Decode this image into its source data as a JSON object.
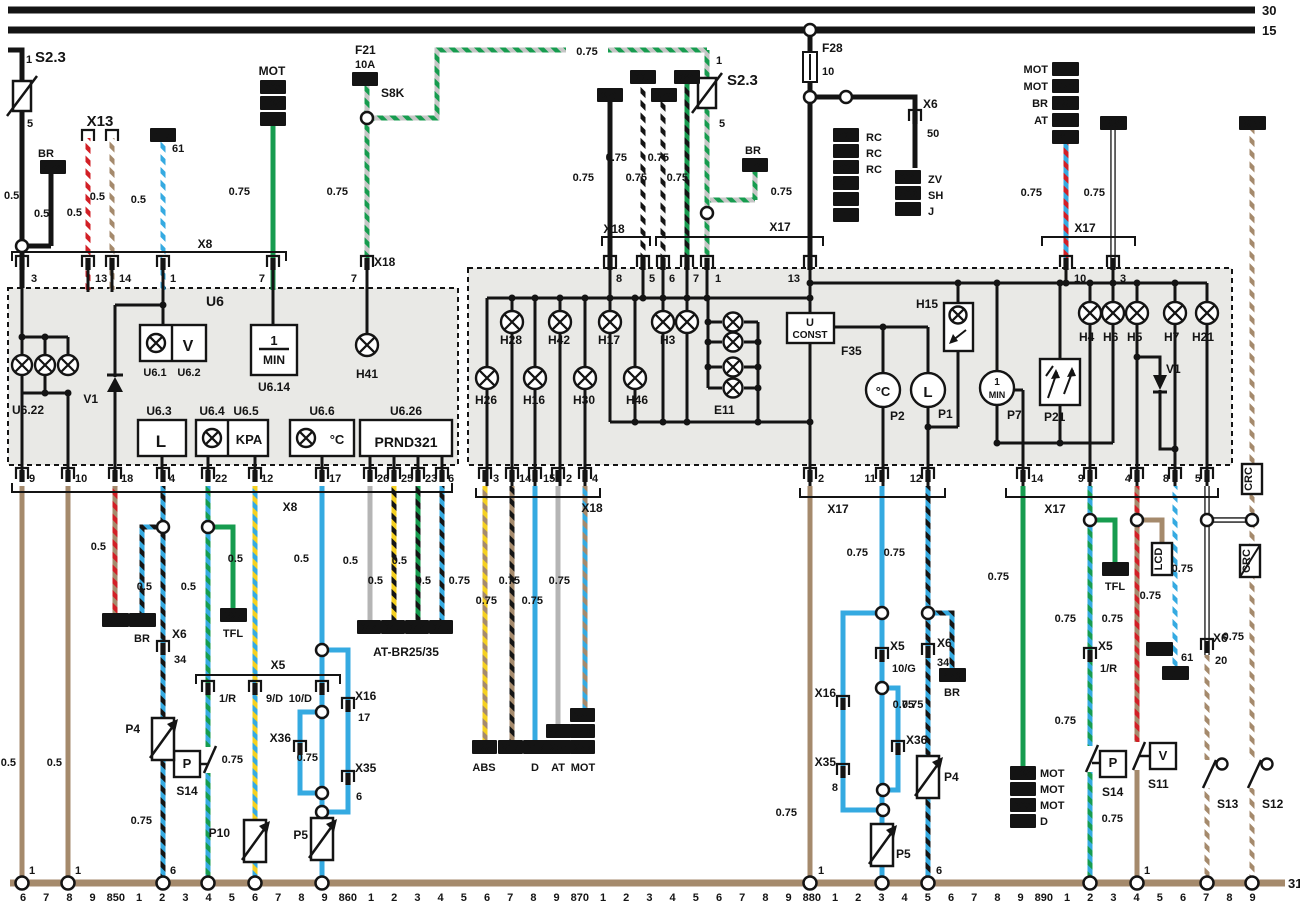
{
  "colors": {
    "black": "#141414",
    "tan": "#a58a6c",
    "red": "#d21f26",
    "green": "#179c4f",
    "blue": "#35aae1",
    "yellow": "#f5d020",
    "gray": "#b5b5b5",
    "lightgray": "#c6c6c6",
    "boxfill": "#e9e9e6",
    "white": "#ffffff"
  },
  "t": {
    "n30": "30",
    "n15": "15",
    "n31": "31",
    "n1": "1",
    "n2": "2",
    "n3": "3",
    "n4": "4",
    "n5": "5",
    "n6": "6",
    "n7": "7",
    "n8": "8",
    "n9": "9",
    "n10": "10",
    "n11": "11",
    "n12": "12",
    "n13": "13",
    "n14": "14",
    "n17": "17",
    "n18": "18",
    "n20": "20",
    "n22": "22",
    "n23": "23",
    "n25": "25",
    "n26": "26",
    "n34": "34",
    "n50": "50",
    "n61": "61",
    "s05": "0.5",
    "s075": "0.75",
    "s23": "S2.3",
    "x5": "X5",
    "x6": "X6",
    "x8": "X8",
    "x13": "X13",
    "x16": "X16",
    "x17": "X17",
    "x18": "X18",
    "x35": "X35",
    "x36": "X36",
    "p1r": "1/R",
    "p9d": "9/D",
    "p10d": "10/D",
    "p10g": "10/G",
    "f21": "F21",
    "f21a": "10A",
    "s8k": "S8K",
    "f28": "F28",
    "f35": "F35",
    "br": "BR",
    "mot": "MOT",
    "at": "AT",
    "rc": "RC",
    "zv": "ZV",
    "sh": "SH",
    "j": "J",
    "tfl": "TFL",
    "abs": "ABS",
    "d": "D",
    "lcd": "LCD",
    "crc": "CRC",
    "atbr": "AT-BR25/35",
    "u6": "U6",
    "u61": "U6.1",
    "u62": "U6.2",
    "u63": "U6.3",
    "u64": "U6.4",
    "u65": "U6.5",
    "u66": "U6.6",
    "u614": "U6.14",
    "u622": "U6.22",
    "u626": "U6.26",
    "l": "L",
    "v": "V",
    "kpa": "KPA",
    "degc": "°C",
    "prnd": "PRND321",
    "one": "1",
    "min": "MIN",
    "u": "U",
    "konst": "CONST",
    "p": "P",
    "v1": "V1",
    "h41": "H41",
    "h28": "H28",
    "h42": "H42",
    "h17": "H17",
    "h3": "H3",
    "h26": "H26",
    "h16": "H16",
    "h30": "H30",
    "h46": "H46",
    "e11": "E11",
    "h15": "H15",
    "h4": "H4",
    "h6": "H6",
    "h5": "H5",
    "h7": "H7",
    "h21": "H21",
    "p1": "P1",
    "p2": "P2",
    "p4": "P4",
    "p5": "P5",
    "p7": "P7",
    "p10": "P10",
    "p21": "P21",
    "s11": "S11",
    "s12": "S12",
    "s13": "S13",
    "s14": "S14",
    "r474": "474",
    "r963": "963",
    "r136": "136",
    "r270": "270",
    "r115": "115",
    "r315": "315",
    "r370": "370",
    "r225": "225",
    "r379": "379",
    "r280": "280",
    "r721": "721",
    "r746": "746",
    "r760": "760",
    "r641": "641",
    "r616": "616",
    "r410": "410",
    "r600": "600",
    "r562": "562",
    "r201": "201",
    "r975": "975",
    "r273": "273",
    "r480": "480",
    "r442": "442",
    "r612": "612",
    "r336": "336",
    "r800": "800",
    "r895": "895",
    "r476": "476",
    "r327": "327",
    "r244": "244",
    "r245": "245",
    "r246": "246",
    "r247": "247",
    "r974": "974",
    "r441": "441",
    "r149": "149",
    "r250": "250",
    "r272": "272",
    "r584": "584",
    "r817": "817",
    "r912": "912",
    "r850": "850",
    "r116": "116"
  },
  "rail": {
    "end": "31",
    "ticks": [
      "6",
      "7",
      "8",
      "9",
      "850",
      "1",
      "2",
      "3",
      "4",
      "5",
      "6",
      "7",
      "8",
      "9",
      "860",
      "1",
      "2",
      "3",
      "4",
      "5",
      "6",
      "7",
      "8",
      "9",
      "870",
      "1",
      "2",
      "3",
      "4",
      "5",
      "6",
      "7",
      "8",
      "9",
      "880",
      "1",
      "2",
      "3",
      "4",
      "5",
      "6",
      "7",
      "8",
      "9",
      "890",
      "1",
      "2",
      "3",
      "4",
      "5",
      "6",
      "7",
      "8",
      "9"
    ]
  }
}
